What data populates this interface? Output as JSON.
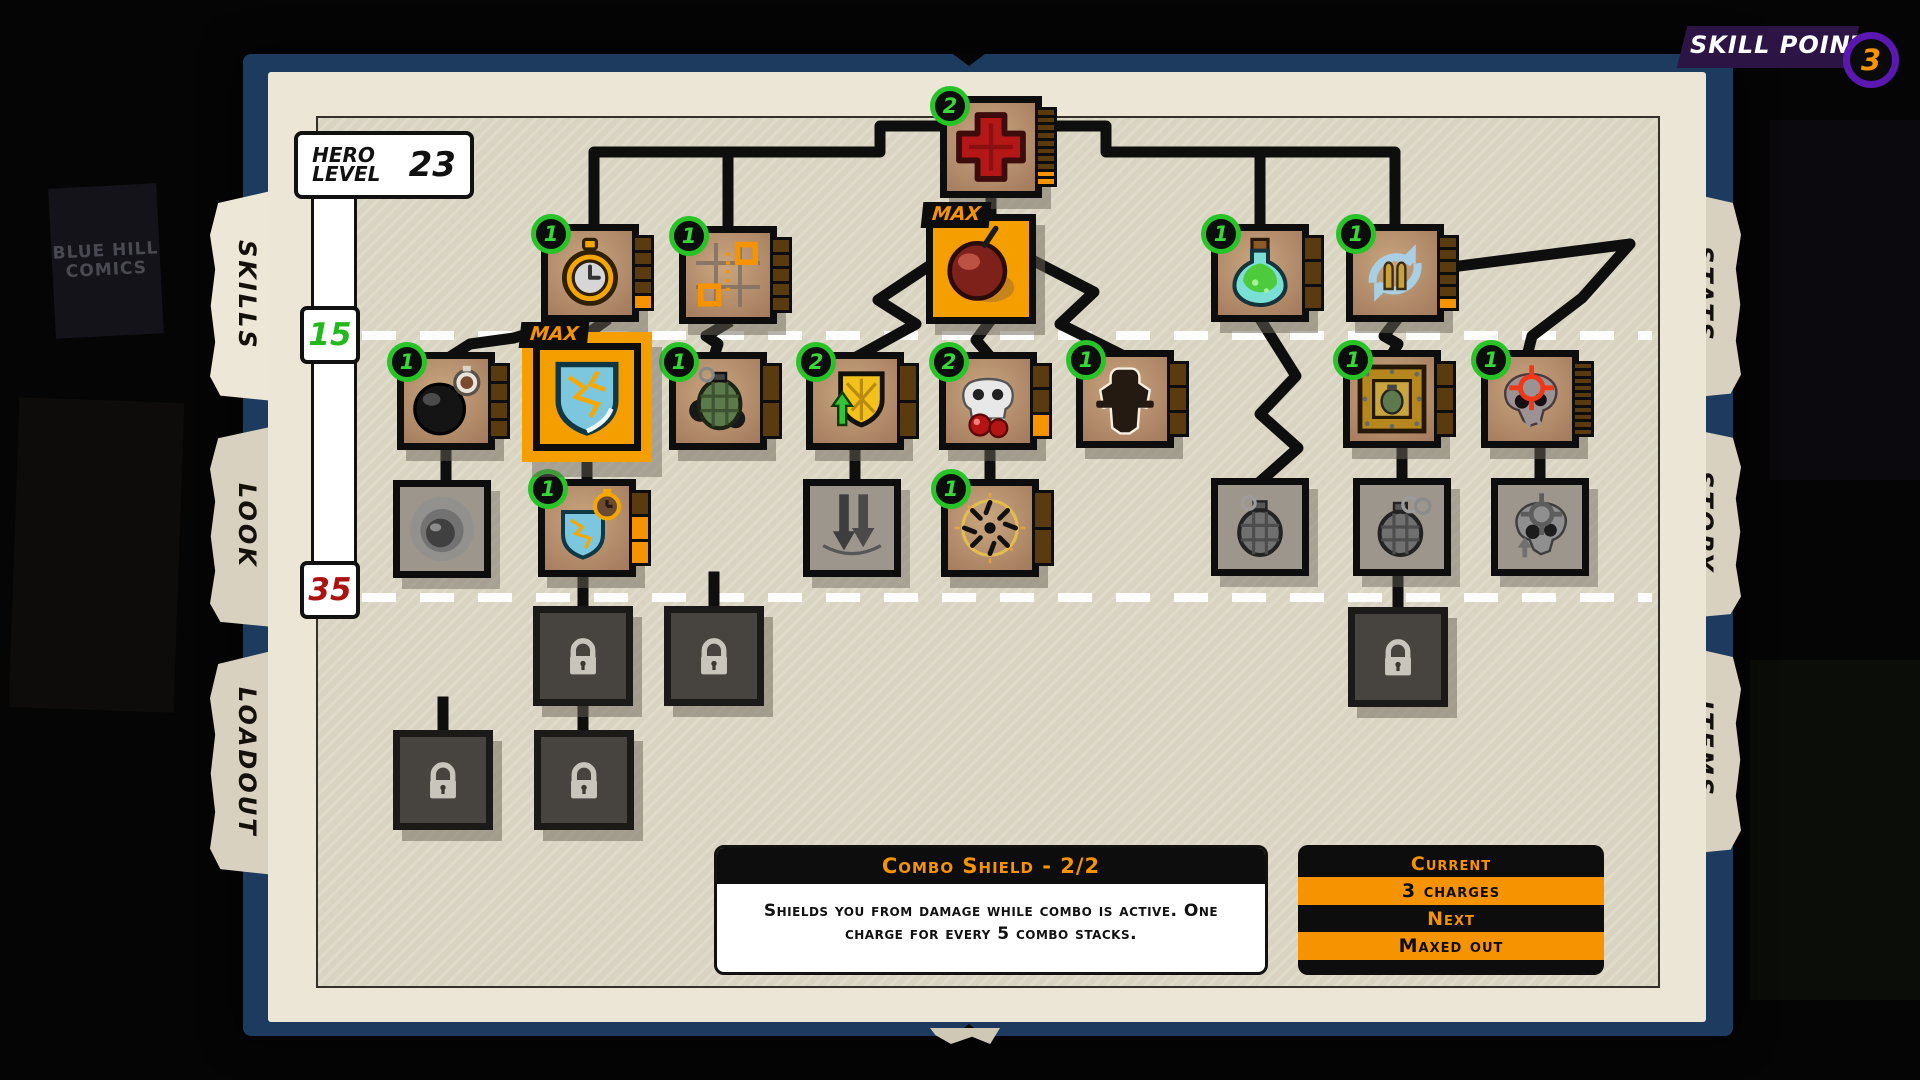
{
  "header": {
    "skill_points_label": "SKILL POINTS",
    "skill_points_value": "3",
    "ring_color": "#5a18b0",
    "value_color": "#f59300"
  },
  "hero": {
    "label_line1": "HERO",
    "label_line2": "LEVEL",
    "value": "23"
  },
  "level_markers": [
    {
      "value": "15",
      "color": "#22b81e"
    },
    {
      "value": "35",
      "color": "#ad1212"
    }
  ],
  "tabs": {
    "left": [
      {
        "label": "SKILLS",
        "active": true
      },
      {
        "label": "LOOK",
        "active": false
      },
      {
        "label": "LOADOUT",
        "active": false
      }
    ],
    "right": [
      {
        "label": "STATS",
        "active": false
      },
      {
        "label": "STORY",
        "active": false
      },
      {
        "label": "ITEMS",
        "active": false
      }
    ]
  },
  "strings": {
    "max_label": "MAX"
  },
  "theme": {
    "orange": "#f59300",
    "badge_green": "#27c327",
    "pip_empty": "#5a3b10",
    "navy_frame": "#1d3a5f",
    "page_cream": "#ebe6d5"
  },
  "background": {
    "poster_text": "BLUE HILL COMICS"
  },
  "tooltip": {
    "title": "Combo Shield - 2/2",
    "body": "Shields you from damage while combo is active. One charge for every 5 combo stacks."
  },
  "upgrade_panel": {
    "current_label": "Current",
    "current_value": "3 charges",
    "next_label": "Next",
    "next_value": "Maxed out"
  },
  "nodes": [
    {
      "id": "health-cross",
      "icon": "cross",
      "x": 940,
      "y": 96,
      "s": 102,
      "badge": "2",
      "pips": {
        "total": 10,
        "filled": 2
      }
    },
    {
      "id": "stopwatch",
      "icon": "stopwatch",
      "x": 541,
      "y": 224,
      "s": 98,
      "badge": "1",
      "pips": {
        "total": 5,
        "filled": 1
      }
    },
    {
      "id": "room-teleport",
      "icon": "teleport",
      "x": 679,
      "y": 226,
      "s": 98,
      "badge": "1",
      "pips": {
        "total": 5,
        "filled": 0
      }
    },
    {
      "id": "cherry-bomb",
      "icon": "bomb",
      "x": 926,
      "y": 214,
      "s": 110,
      "state": "max"
    },
    {
      "id": "potion",
      "icon": "potion",
      "x": 1211,
      "y": 224,
      "s": 98,
      "badge": "1",
      "pips": {
        "total": 3,
        "filled": 0
      }
    },
    {
      "id": "ammo-reload",
      "icon": "reload",
      "x": 1346,
      "y": 224,
      "s": 98,
      "badge": "1",
      "pips": {
        "total": 6,
        "filled": 1
      }
    },
    {
      "id": "time-bomb",
      "icon": "bomb-timer",
      "x": 397,
      "y": 352,
      "s": 98,
      "badge": "1",
      "pips": {
        "total": 4,
        "filled": 0
      }
    },
    {
      "id": "combo-shield",
      "icon": "shield-combo",
      "x": 533,
      "y": 343,
      "s": 108,
      "state": "selected"
    },
    {
      "id": "grenade",
      "icon": "grenade",
      "x": 669,
      "y": 352,
      "s": 98,
      "badge": "1",
      "pips": {
        "total": 2,
        "filled": 0
      }
    },
    {
      "id": "shield-upgrade",
      "icon": "shield-up",
      "x": 806,
      "y": 352,
      "s": 98,
      "badge": "2",
      "pips": {
        "total": 2,
        "filled": 0
      }
    },
    {
      "id": "skull-cherries",
      "icon": "skull-cherry",
      "x": 939,
      "y": 352,
      "s": 98,
      "badge": "2",
      "pips": {
        "total": 3,
        "filled": 1
      }
    },
    {
      "id": "hero-rage",
      "icon": "silhouette",
      "x": 1076,
      "y": 350,
      "s": 98,
      "badge": "1",
      "pips": {
        "total": 3,
        "filled": 0
      }
    },
    {
      "id": "crate-grenade",
      "icon": "crate-grenade",
      "x": 1343,
      "y": 350,
      "s": 98,
      "badge": "1",
      "pips": {
        "total": 3,
        "filled": 0
      }
    },
    {
      "id": "skull-target",
      "icon": "skull-target",
      "x": 1481,
      "y": 350,
      "s": 98,
      "badge": "1",
      "pips": {
        "total": 10,
        "filled": 0
      }
    },
    {
      "id": "ghost-orb",
      "icon": "orb",
      "x": 393,
      "y": 480,
      "s": 98,
      "state": "disabled"
    },
    {
      "id": "shield-duration",
      "icon": "shield-timer",
      "x": 538,
      "y": 479,
      "s": 98,
      "badge": "1",
      "pips": {
        "total": 3,
        "filled": 2
      }
    },
    {
      "id": "ground-slam",
      "icon": "slam-arrows",
      "x": 803,
      "y": 479,
      "s": 98,
      "state": "disabled"
    },
    {
      "id": "combo-nova",
      "icon": "nova",
      "x": 941,
      "y": 479,
      "s": 98,
      "badge": "1",
      "pips": {
        "total": 2,
        "filled": 0
      }
    },
    {
      "id": "frag-grenade",
      "icon": "grenade-frag",
      "x": 1211,
      "y": 478,
      "s": 98,
      "state": "disabled"
    },
    {
      "id": "double-grenade",
      "icon": "grenade-double",
      "x": 1353,
      "y": 478,
      "s": 98,
      "state": "disabled"
    },
    {
      "id": "skull-mark",
      "icon": "skull-gray",
      "x": 1491,
      "y": 478,
      "s": 98,
      "state": "disabled"
    },
    {
      "id": "locked-1",
      "icon": "padlock",
      "x": 533,
      "y": 606,
      "s": 100,
      "state": "locked"
    },
    {
      "id": "locked-2",
      "icon": "padlock",
      "x": 664,
      "y": 606,
      "s": 100,
      "state": "locked"
    },
    {
      "id": "locked-3",
      "icon": "padlock",
      "x": 1348,
      "y": 607,
      "s": 100,
      "state": "locked"
    },
    {
      "id": "locked-4",
      "icon": "padlock",
      "x": 393,
      "y": 730,
      "s": 100,
      "state": "locked"
    },
    {
      "id": "locked-5",
      "icon": "padlock",
      "x": 534,
      "y": 730,
      "s": 100,
      "state": "locked"
    }
  ]
}
